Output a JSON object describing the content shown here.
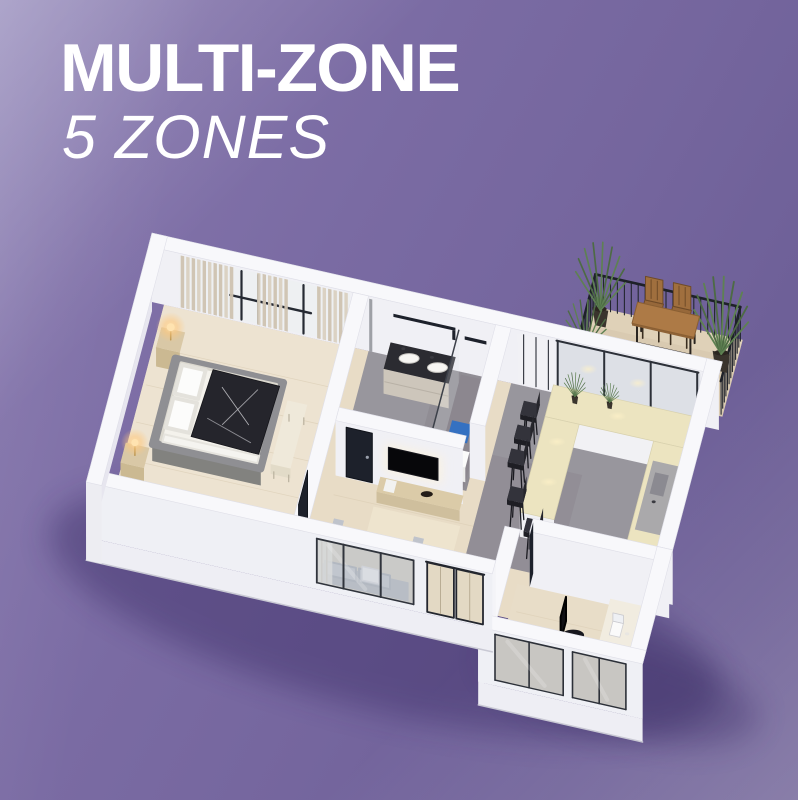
{
  "header": {
    "title": "MULTI-ZONE",
    "subtitle": "5 ZONES"
  },
  "scene": {
    "zones": [
      "bedroom",
      "bathroom",
      "living-room",
      "kitchen-dining",
      "office"
    ],
    "outdoor": "balcony"
  },
  "colors": {
    "background_light": "#9186b8",
    "background_base": "#7a6ba3",
    "background_dark": "#685a91",
    "title_text": "#ffffff",
    "wall_top": "#f8f8fb",
    "wall_south": "#f0f0f5",
    "wall_west": "#fafafc",
    "wall_edge": "#dfdfe8",
    "wall_outer": "#f4f4f8",
    "wall_outer_low": "#e7e6ef",
    "slab": "#eeeef4",
    "floor_wood": "#e8dcc6",
    "floor_wood_light": "#efe6d4",
    "plank_line": "#d9cbb2",
    "floor_tile": "#98969d",
    "floor_tile_dark": "#878289",
    "floor_balcony": "#d9cab1",
    "counter_top": "#ece4c0",
    "cabinet_face": "#f1f1f4",
    "wood_furniture": "#d7c6a3",
    "dark_fixture": "#1d212b",
    "sofa_base": "#b2b5bd",
    "sofa_cushion": "#c9cdd4",
    "bed_frame": "#8f8f93",
    "bed_duvet": "#25252c",
    "bed_white": "#f4f2ec",
    "curtain": "#d9d0c0",
    "curtain_dark": "#cdc2b0",
    "glass": "#c3cad2",
    "mat_blue": "#2e6fc6",
    "plant_green": "#4d6b44",
    "plant_green_light": "#5e8152",
    "table_wood": "#ad7a46",
    "lamp_glow": "#ffc87d",
    "shadow": "#352761"
  }
}
